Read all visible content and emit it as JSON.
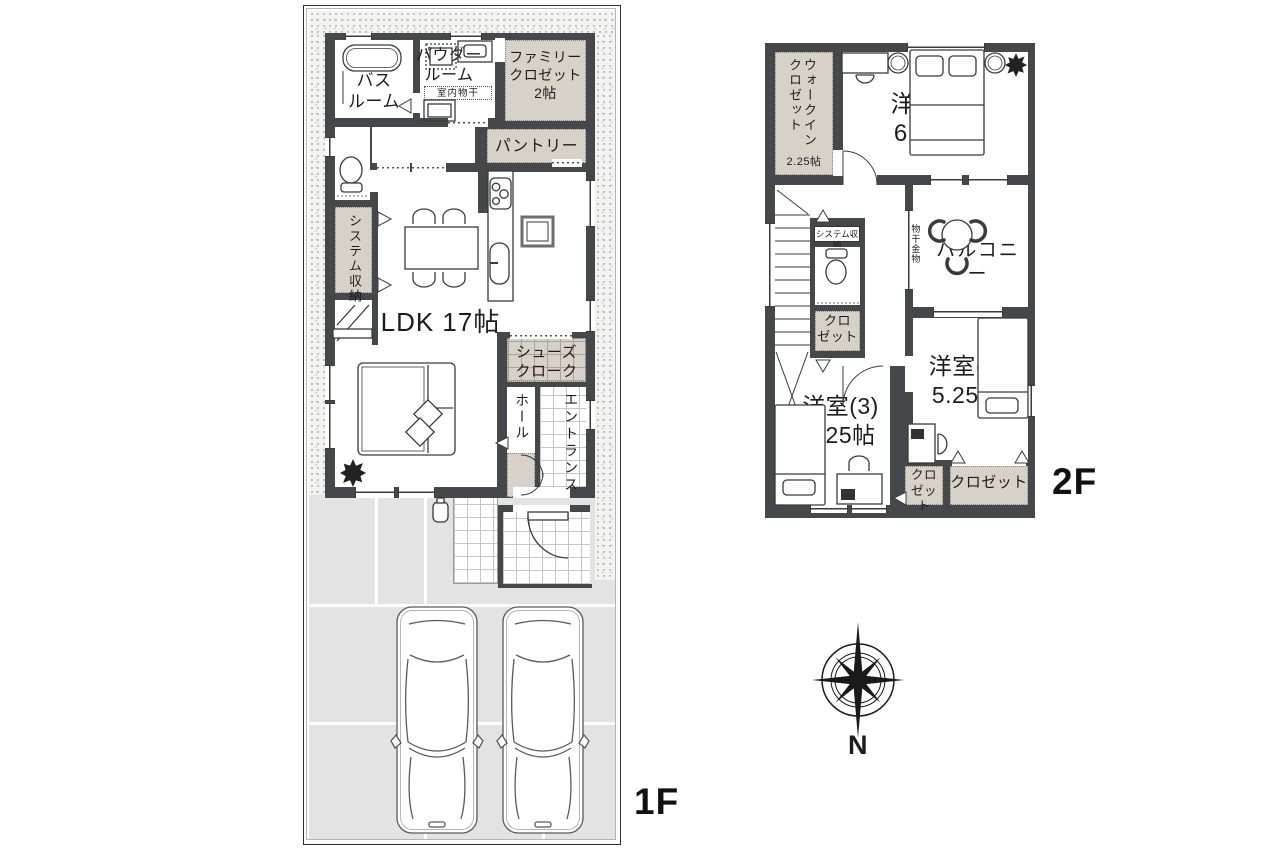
{
  "colors": {
    "wall": "#46474b",
    "closet": "#d8d1c8",
    "paving": "#e3e3e4"
  },
  "f1": {
    "floor_label": "1F",
    "bath": "バス\nルーム",
    "powder": "パウダー\nルーム",
    "indoor_drying": "室内物干",
    "family_closet": "ファミリー\nクロゼット\n2帖",
    "pantry": "パントリー",
    "system_storage": "システム収納",
    "ldk": "LDK 17帖",
    "shoes_closet": "シューズ\nクローク",
    "hall": "ホール",
    "entrance": "エントランス"
  },
  "f2": {
    "floor_label": "2F",
    "walk_in_closet": "ウォークイン\nクロゼット",
    "walk_in_closet_size": "2.25帖",
    "room1": "洋室(1)\n6.75帖",
    "system_storage": "システム収納",
    "laundry_hardware": "物干金物",
    "balcony": "バルコニー",
    "closet_mid": "クロ\nゼット",
    "room2": "洋室(2)\n5.25帖",
    "room3": "洋室(3)\n5.25帖",
    "closet_small": "クロ\nゼット",
    "closet_wide": "クロゼット"
  },
  "compass": {
    "north": "N"
  }
}
